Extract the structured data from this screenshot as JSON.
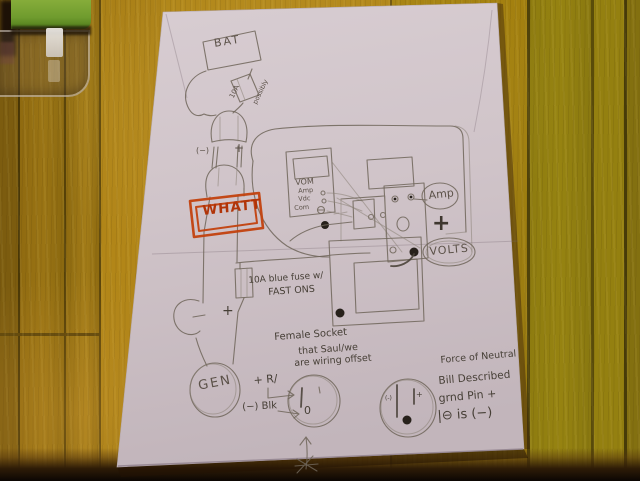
{
  "diagram": {
    "battery": "BAT",
    "fuse_top": {
      "rating": "10A",
      "note": "possibly"
    },
    "connector": {
      "neg": "(−)",
      "pos": "+"
    },
    "whatt": "WHATT",
    "vom": {
      "title": "VOM",
      "jack_amp": "Amp",
      "jack_vdc": "Vdc",
      "jack_com": "Com"
    },
    "meter": {
      "amp": "Amp",
      "plus": "+",
      "volts": "VOLTS"
    },
    "fuse_blue": {
      "line1": "10A blue fuse w/",
      "line2": "FAST ONS"
    },
    "wire_pos": "+",
    "generator": "GEN",
    "socket_note": {
      "line1": "Female Socket",
      "line2": "that Saul/we",
      "line3": "are wiring offset"
    },
    "left_socket": {
      "pos_wire": "+ R/",
      "neg_wire": "(−) Blk",
      "zero": "0"
    },
    "right_socket": {
      "neg_mark": "(-)",
      "pos_mark": "+"
    },
    "neutral_note": {
      "line1": "Force of Neutral",
      "line2": "Bill Described",
      "line3": "grnd Pin +",
      "line4": "|⊖ is (−)"
    }
  }
}
